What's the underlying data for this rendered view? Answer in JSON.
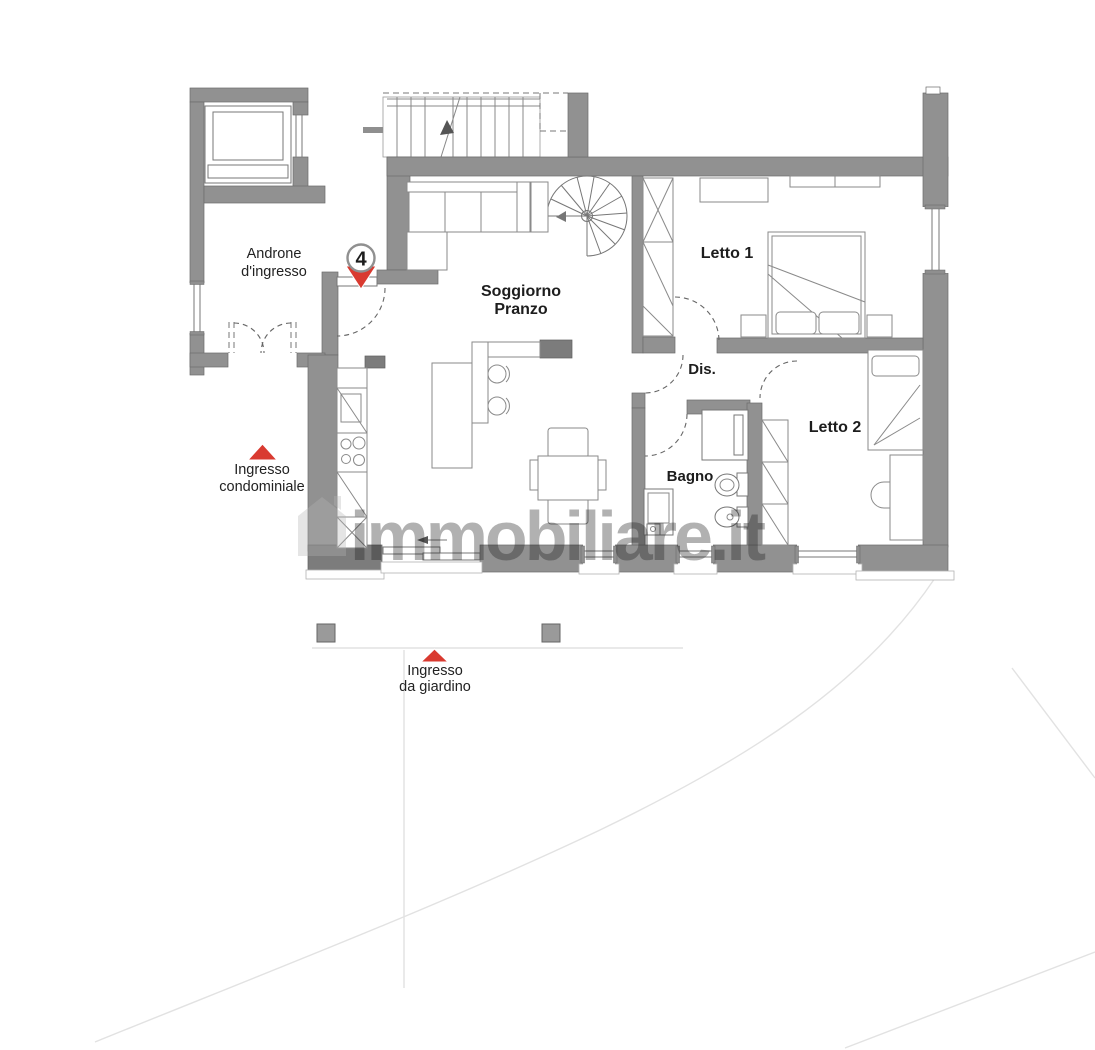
{
  "colors": {
    "wall": "#919191",
    "wall_dark": "#7c7c7c",
    "accent_red": "#d93a30",
    "watermark": "#b5b5b5"
  },
  "watermark": {
    "text": "immobiliare.it"
  },
  "unit_marker": {
    "number": "4"
  },
  "rooms": {
    "androne": {
      "line1": "Androne",
      "line2": "d'ingresso"
    },
    "soggiorno": {
      "line1": "Soggiorno",
      "line2": "Pranzo"
    },
    "letto1": {
      "label": "Letto 1"
    },
    "letto2": {
      "label": "Letto 2"
    },
    "dis": {
      "label": "Dis."
    },
    "bagno": {
      "label": "Bagno"
    }
  },
  "entrances": {
    "condominiale": {
      "line1": "Ingresso",
      "line2": "condominiale"
    },
    "giardino": {
      "line1": "Ingresso",
      "line2": "da giardino"
    }
  }
}
